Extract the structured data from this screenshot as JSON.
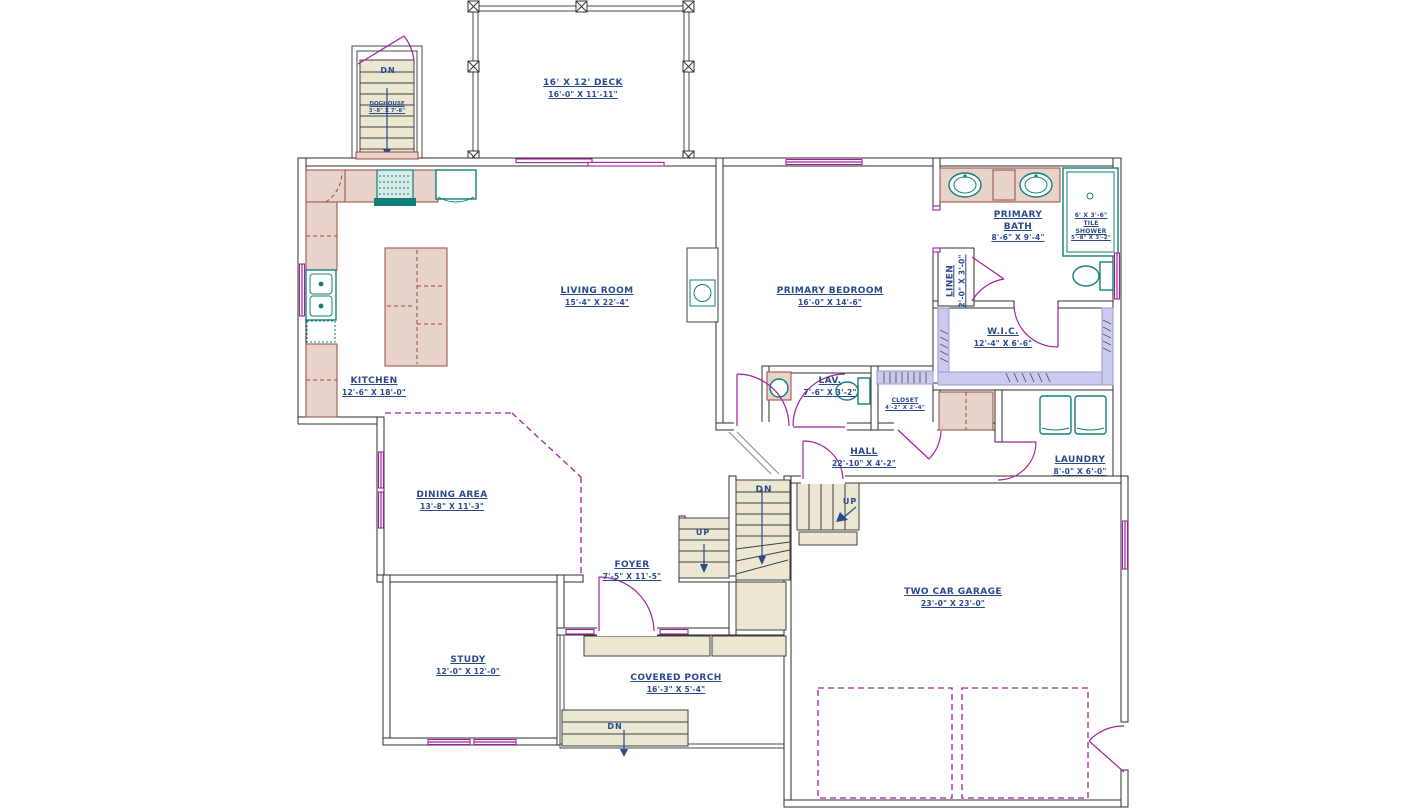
{
  "rooms": {
    "deck": {
      "name": "16' X 12' DECK",
      "dims": "16'-0\" X 11'-11\""
    },
    "deck_stairs": {
      "name": "DOGHOUSE",
      "dims": "3'-8\" X 7'-8\""
    },
    "kitchen": {
      "name": "KITCHEN",
      "dims": "12'-6\" X 18'-0\""
    },
    "living_room": {
      "name": "LIVING ROOM",
      "dims": "15'-4\" X 22'-4\""
    },
    "primary_bedroom": {
      "name": "PRIMARY BEDROOM",
      "dims": "16'-0\" X 14'-6\""
    },
    "primary_bath": {
      "name": "PRIMARY BATH",
      "dims": "8'-6\" X 9'-4\""
    },
    "tile_shower": {
      "name": "6' X 3'-6\" TILE SHOWER",
      "dims": "5'-8\" X 3'-2\""
    },
    "linen": {
      "name": "LINEN",
      "dims": "2'-0\" X 3'-0\""
    },
    "wic": {
      "name": "W.I.C.",
      "dims": "12'-4\" X 6'-6\""
    },
    "lav": {
      "name": "LAV.",
      "dims": "7'-6\" X 3'-2\""
    },
    "closet": {
      "name": "CLOSET",
      "dims": "4'-2\" X 2'-4\""
    },
    "hall": {
      "name": "HALL",
      "dims": "22'-10\" X 4'-2\""
    },
    "laundry": {
      "name": "LAUNDRY",
      "dims": "8'-0\" X 6'-0\""
    },
    "dining_area": {
      "name": "DINING AREA",
      "dims": "13'-8\" X 11'-3\""
    },
    "foyer": {
      "name": "FOYER",
      "dims": "7'-5\" X 11'-5\""
    },
    "study": {
      "name": "STUDY",
      "dims": "12'-0\" X 12'-0\""
    },
    "covered_porch": {
      "name": "COVERED PORCH",
      "dims": "16'-3\" X 5'-4\""
    },
    "garage": {
      "name": "TWO CAR GARAGE",
      "dims": "23'-0\" X 23'-0\""
    }
  },
  "stairs": {
    "main_down": "DN",
    "basement_up": "UP",
    "garage_up": "UP",
    "deck_down": "DN",
    "porch_down": "DN"
  },
  "colors": {
    "label_blue": "#2b4a8b",
    "door_magenta": "#a0209f",
    "fixture_teal": "#117f78",
    "counter_tan": "#e7d3c9",
    "counter_edge": "#96493f",
    "stair_beige": "#ece7d2",
    "shelf_lavender": "#cacaee",
    "wall_dark": "#2e2e2e"
  }
}
